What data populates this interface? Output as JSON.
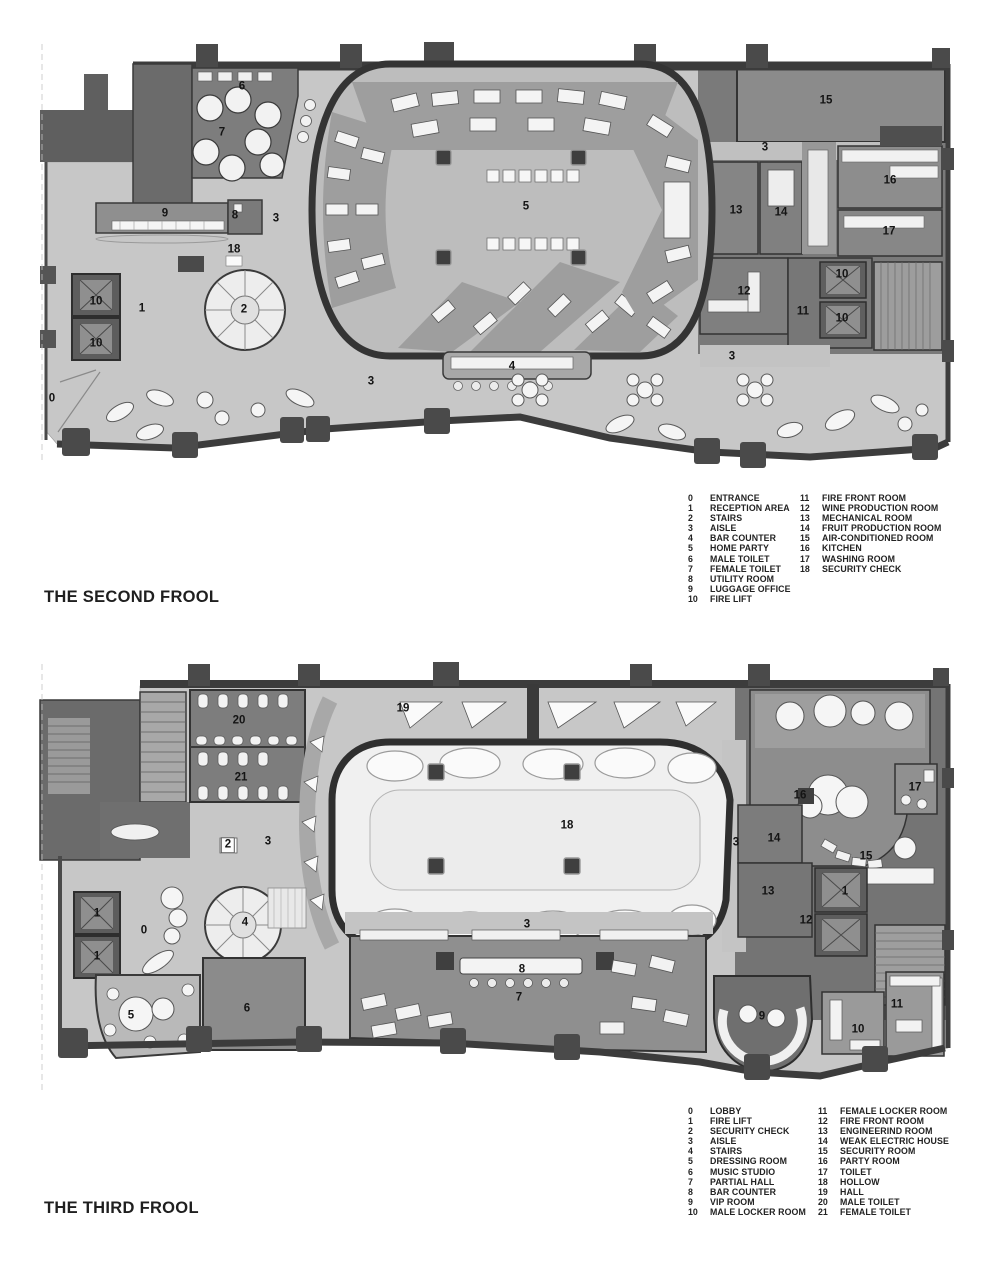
{
  "palette": {
    "floor_light": "#c7c7c7",
    "floor_mid": "#a2a2a2",
    "room_mid": "#8b8b8b",
    "room_dark": "#6e6e6e",
    "wall": "#3c3c3c",
    "wall_dark": "#2e2e2e",
    "fixture": "#f4f4f4",
    "ink": "#1c1c1c"
  },
  "floors": [
    {
      "id": "second",
      "title": "THE SECOND FROOL",
      "legend": {
        "col1": [
          {
            "num": "0",
            "label": "ENTRANCE"
          },
          {
            "num": "1",
            "label": "RECEPTION AREA"
          },
          {
            "num": "2",
            "label": "STAIRS"
          },
          {
            "num": "3",
            "label": "AISLE"
          },
          {
            "num": "4",
            "label": "BAR COUNTER"
          },
          {
            "num": "5",
            "label": "HOME PARTY"
          },
          {
            "num": "6",
            "label": "MALE TOILET"
          },
          {
            "num": "7",
            "label": "FEMALE TOILET"
          },
          {
            "num": "8",
            "label": "UTILITY ROOM"
          },
          {
            "num": "9",
            "label": "LUGGAGE OFFICE"
          },
          {
            "num": "10",
            "label": "FIRE LIFT"
          }
        ],
        "col2": [
          {
            "num": "11",
            "label": "FIRE FRONT ROOM"
          },
          {
            "num": "12",
            "label": "WINE PRODUCTION ROOM"
          },
          {
            "num": "13",
            "label": "MECHANICAL ROOM"
          },
          {
            "num": "14",
            "label": "FRUIT PRODUCTION ROOM"
          },
          {
            "num": "15",
            "label": "AIR-CONDITIONED ROOM"
          },
          {
            "num": "16",
            "label": "KITCHEN"
          },
          {
            "num": "17",
            "label": "WASHING ROOM"
          },
          {
            "num": "18",
            "label": "SECURITY CHECK"
          }
        ]
      },
      "plan_labels": [
        {
          "n": "6",
          "x": 242,
          "y": 87
        },
        {
          "n": "7",
          "x": 222,
          "y": 133
        },
        {
          "n": "9",
          "x": 165,
          "y": 214
        },
        {
          "n": "8",
          "x": 235,
          "y": 216
        },
        {
          "n": "3",
          "x": 276,
          "y": 219
        },
        {
          "n": "18",
          "x": 234,
          "y": 250
        },
        {
          "n": "5",
          "x": 526,
          "y": 207
        },
        {
          "n": "15",
          "x": 826,
          "y": 101
        },
        {
          "n": "3",
          "x": 765,
          "y": 148
        },
        {
          "n": "13",
          "x": 736,
          "y": 211
        },
        {
          "n": "14",
          "x": 781,
          "y": 213
        },
        {
          "n": "16",
          "x": 890,
          "y": 181
        },
        {
          "n": "17",
          "x": 889,
          "y": 232
        },
        {
          "n": "10",
          "x": 96,
          "y": 302
        },
        {
          "n": "10",
          "x": 96,
          "y": 344
        },
        {
          "n": "1",
          "x": 142,
          "y": 309
        },
        {
          "n": "2",
          "x": 244,
          "y": 310
        },
        {
          "n": "12",
          "x": 744,
          "y": 292
        },
        {
          "n": "11",
          "x": 803,
          "y": 312
        },
        {
          "n": "10",
          "x": 842,
          "y": 275
        },
        {
          "n": "10",
          "x": 842,
          "y": 319
        },
        {
          "n": "0",
          "x": 52,
          "y": 399
        },
        {
          "n": "3",
          "x": 371,
          "y": 382
        },
        {
          "n": "4",
          "x": 512,
          "y": 367
        },
        {
          "n": "3",
          "x": 732,
          "y": 357
        }
      ]
    },
    {
      "id": "third",
      "title": "THE THIRD FROOL",
      "legend": {
        "col1": [
          {
            "num": "0",
            "label": "LOBBY"
          },
          {
            "num": "1",
            "label": "FIRE LIFT"
          },
          {
            "num": "2",
            "label": "SECURITY CHECK"
          },
          {
            "num": "3",
            "label": "AISLE"
          },
          {
            "num": "4",
            "label": "STAIRS"
          },
          {
            "num": "5",
            "label": "DRESSING ROOM"
          },
          {
            "num": "6",
            "label": "MUSIC STUDIO"
          },
          {
            "num": "7",
            "label": "PARTIAL HALL"
          },
          {
            "num": "8",
            "label": "BAR COUNTER"
          },
          {
            "num": "9",
            "label": "VIP ROOM"
          },
          {
            "num": "10",
            "label": "MALE LOCKER ROOM"
          }
        ],
        "col2": [
          {
            "num": "11",
            "label": "FEMALE LOCKER ROOM"
          },
          {
            "num": "12",
            "label": "FIRE FRONT ROOM"
          },
          {
            "num": "13",
            "label": "ENGINEERIND ROOM"
          },
          {
            "num": "14",
            "label": "WEAK ELECTRIC HOUSE"
          },
          {
            "num": "15",
            "label": "SECURITY ROOM"
          },
          {
            "num": "16",
            "label": "PARTY ROOM"
          },
          {
            "num": "17",
            "label": "TOILET"
          },
          {
            "num": "18",
            "label": "HOLLOW"
          },
          {
            "num": "19",
            "label": "HALL"
          },
          {
            "num": "20",
            "label": "MALE TOILET"
          },
          {
            "num": "21",
            "label": "FEMALE TOILET"
          }
        ]
      },
      "plan_labels": [
        {
          "n": "20",
          "x": 239,
          "y": 721
        },
        {
          "n": "21",
          "x": 241,
          "y": 778
        },
        {
          "n": "19",
          "x": 403,
          "y": 709
        },
        {
          "n": "2",
          "x": 228,
          "y": 845,
          "boxed": true
        },
        {
          "n": "3",
          "x": 268,
          "y": 842
        },
        {
          "n": "18",
          "x": 567,
          "y": 826
        },
        {
          "n": "3",
          "x": 736,
          "y": 843
        },
        {
          "n": "16",
          "x": 800,
          "y": 796
        },
        {
          "n": "17",
          "x": 915,
          "y": 788
        },
        {
          "n": "14",
          "x": 774,
          "y": 839
        },
        {
          "n": "15",
          "x": 866,
          "y": 857
        },
        {
          "n": "13",
          "x": 768,
          "y": 892
        },
        {
          "n": "1",
          "x": 845,
          "y": 892
        },
        {
          "n": "12",
          "x": 806,
          "y": 921
        },
        {
          "n": "1",
          "x": 97,
          "y": 914
        },
        {
          "n": "1",
          "x": 97,
          "y": 957
        },
        {
          "n": "0",
          "x": 144,
          "y": 931
        },
        {
          "n": "4",
          "x": 245,
          "y": 923
        },
        {
          "n": "5",
          "x": 131,
          "y": 1016
        },
        {
          "n": "6",
          "x": 247,
          "y": 1009
        },
        {
          "n": "3",
          "x": 527,
          "y": 925
        },
        {
          "n": "8",
          "x": 522,
          "y": 970
        },
        {
          "n": "7",
          "x": 519,
          "y": 998
        },
        {
          "n": "9",
          "x": 762,
          "y": 1017
        },
        {
          "n": "10",
          "x": 858,
          "y": 1030
        },
        {
          "n": "11",
          "x": 897,
          "y": 1005
        }
      ]
    }
  ]
}
